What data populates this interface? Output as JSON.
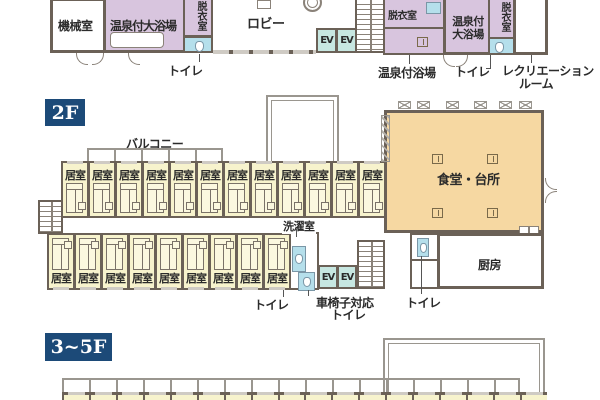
{
  "colors": {
    "wall": "#6b6157",
    "room_yellow": "#f7f3cd",
    "bath_purple": "#d8c5de",
    "dining_orange": "#f6d8a2",
    "ev_teal": "#c7e7e1",
    "toilet_blue": "#b5dfeb",
    "badge_navy": "#1c4a78",
    "rail_gray": "#9a968f"
  },
  "floor1": {
    "machine_room": "機械室",
    "bath_left": "温泉付大浴場",
    "dressing_left": "脱衣室",
    "toilet_label_left": "トイレ",
    "lobby": "ロビー",
    "ev": "EV",
    "dressing_mid": "脱衣室",
    "bath_mid_label": "温泉付浴場",
    "bath_right_l1": "温泉付",
    "bath_right_l2": "大浴場",
    "dressing_right": "脱衣室",
    "toilet_label_right": "トイレ",
    "recreation_l1": "レクリエーション",
    "recreation_l2": "ルーム"
  },
  "floor2": {
    "badge": "2F",
    "balcony": "バルコニー",
    "room": "居室",
    "rooms_top": 12,
    "rooms_bottom": 9,
    "laundry": "洗濯室",
    "toilet_left_label": "トイレ",
    "wheelchair_l1": "車椅子対応",
    "wheelchair_l2": "トイレ",
    "ev": "EV",
    "dining": "食堂・台所",
    "kitchen": "厨房",
    "toilet_right_label": "トイレ"
  },
  "floor35": {
    "badge": "3~5F",
    "strip_rooms": 18
  }
}
